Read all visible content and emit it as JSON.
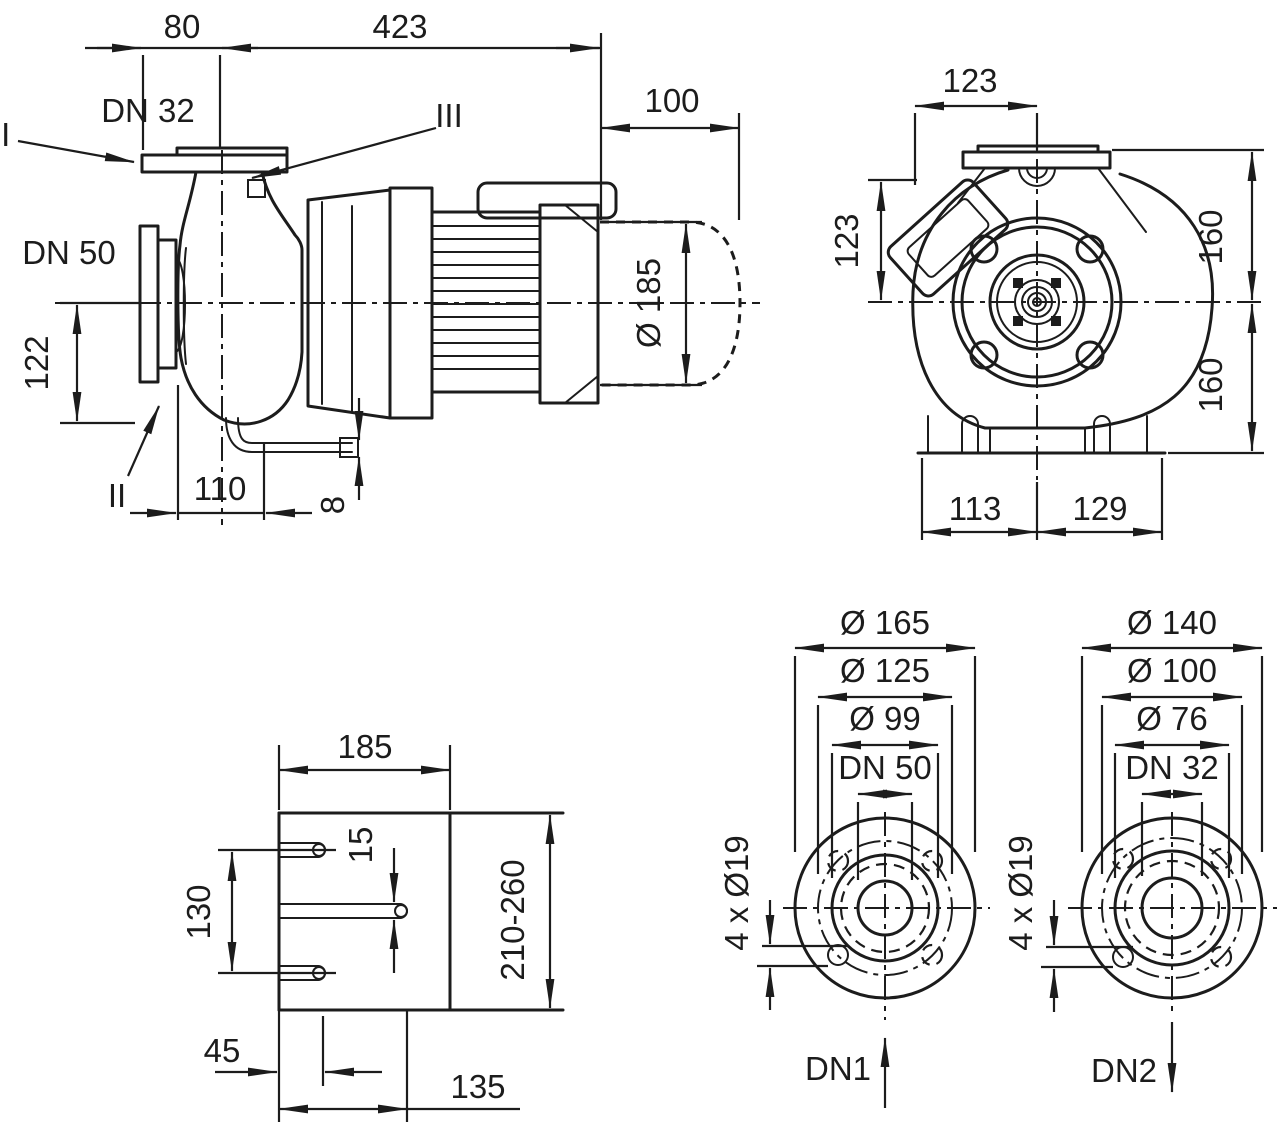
{
  "colors": {
    "line": "#1c1c1c",
    "background": "#ffffff"
  },
  "side_view": {
    "labels": {
      "dn32": "DN 32",
      "dn50": "DN 50",
      "marker_left": "II",
      "marker_mid": "III",
      "marker_bottom": "II"
    },
    "dims": {
      "length_80": "80",
      "length_423": "423",
      "length_100": "100",
      "dia_185": "Ø 185",
      "height_122": "122",
      "length_110": "110",
      "height_8": "8"
    }
  },
  "front_view": {
    "dims": {
      "width_123": "123",
      "height_123": "123",
      "top_160": "160",
      "bottom_160": "160",
      "left_113": "113",
      "right_129": "129"
    }
  },
  "base_plate": {
    "dims": {
      "width_185": "185",
      "slot_15": "15",
      "spacing_130": "130",
      "range_210_260": "210-260",
      "offset_45": "45",
      "length_135": "135"
    }
  },
  "flange_dn1": {
    "label": "DN1",
    "dims": {
      "outer": "Ø 165",
      "bolt_circle": "Ø 125",
      "face": "Ø 99",
      "bore": "DN 50",
      "holes": "4 x Ø19"
    }
  },
  "flange_dn2": {
    "label": "DN2",
    "dims": {
      "outer": "Ø 140",
      "bolt_circle": "Ø 100",
      "face": "Ø 76",
      "bore": "DN 32",
      "holes": "4 x Ø19"
    }
  }
}
